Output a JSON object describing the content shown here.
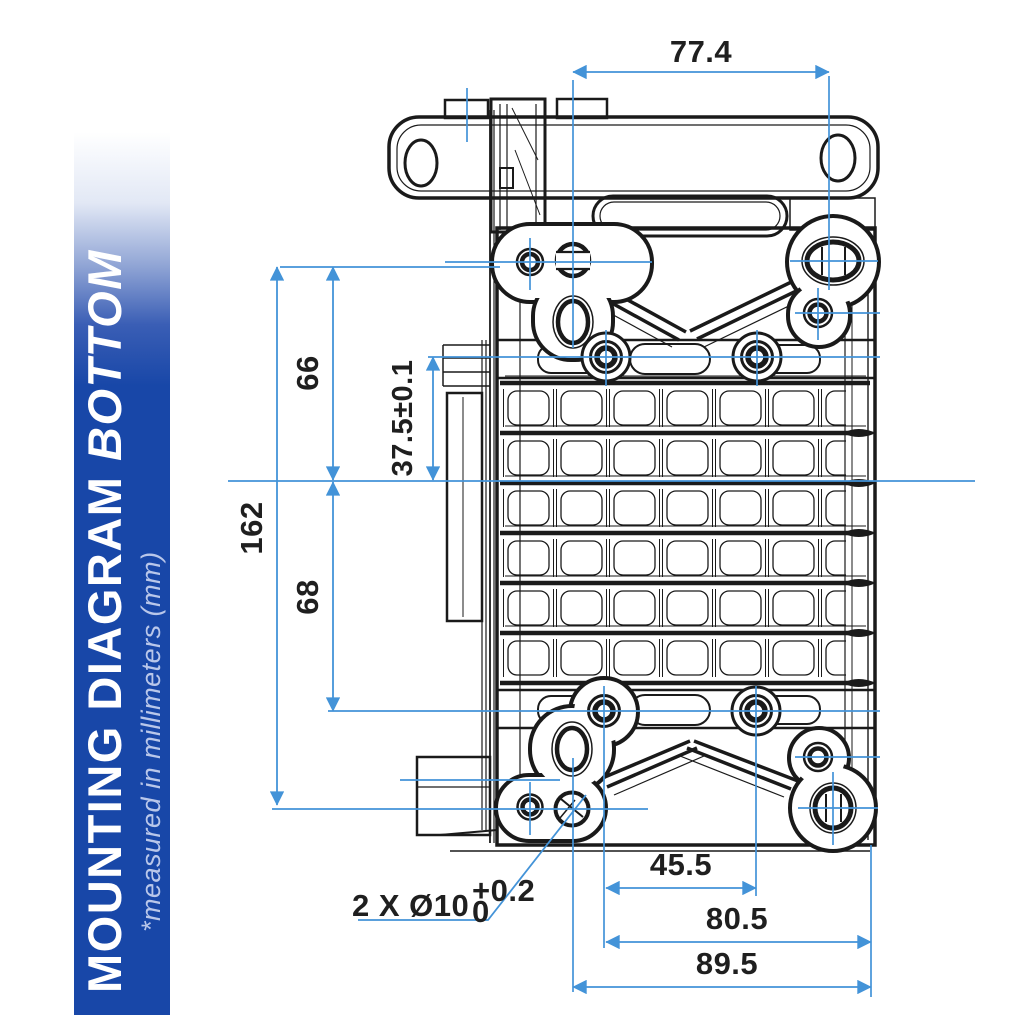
{
  "banner": {
    "title": "MOUNTING DIAGRAM",
    "title_emphasis": "BOTTOM",
    "subtitle": "*measured in millimeters (mm)"
  },
  "dims": {
    "top_width": "77.4",
    "upper_height": "66",
    "total_height": "162",
    "offset_height": "37.5±0.1",
    "lower_height": "68",
    "bottom_inner": "45.5",
    "bottom_mid": "80.5",
    "bottom_outer": "89.5"
  },
  "callout": {
    "text": "2 X Ø10",
    "tol_plus": "+0.2",
    "tol_base": "0"
  },
  "colors": {
    "banner_blue": "#1847a8",
    "banner_subtitle": "#b9c7ea",
    "dimension_blue": "#4393d8",
    "line_black": "#1a1a1a",
    "dim_text": "#1f1f1f"
  }
}
